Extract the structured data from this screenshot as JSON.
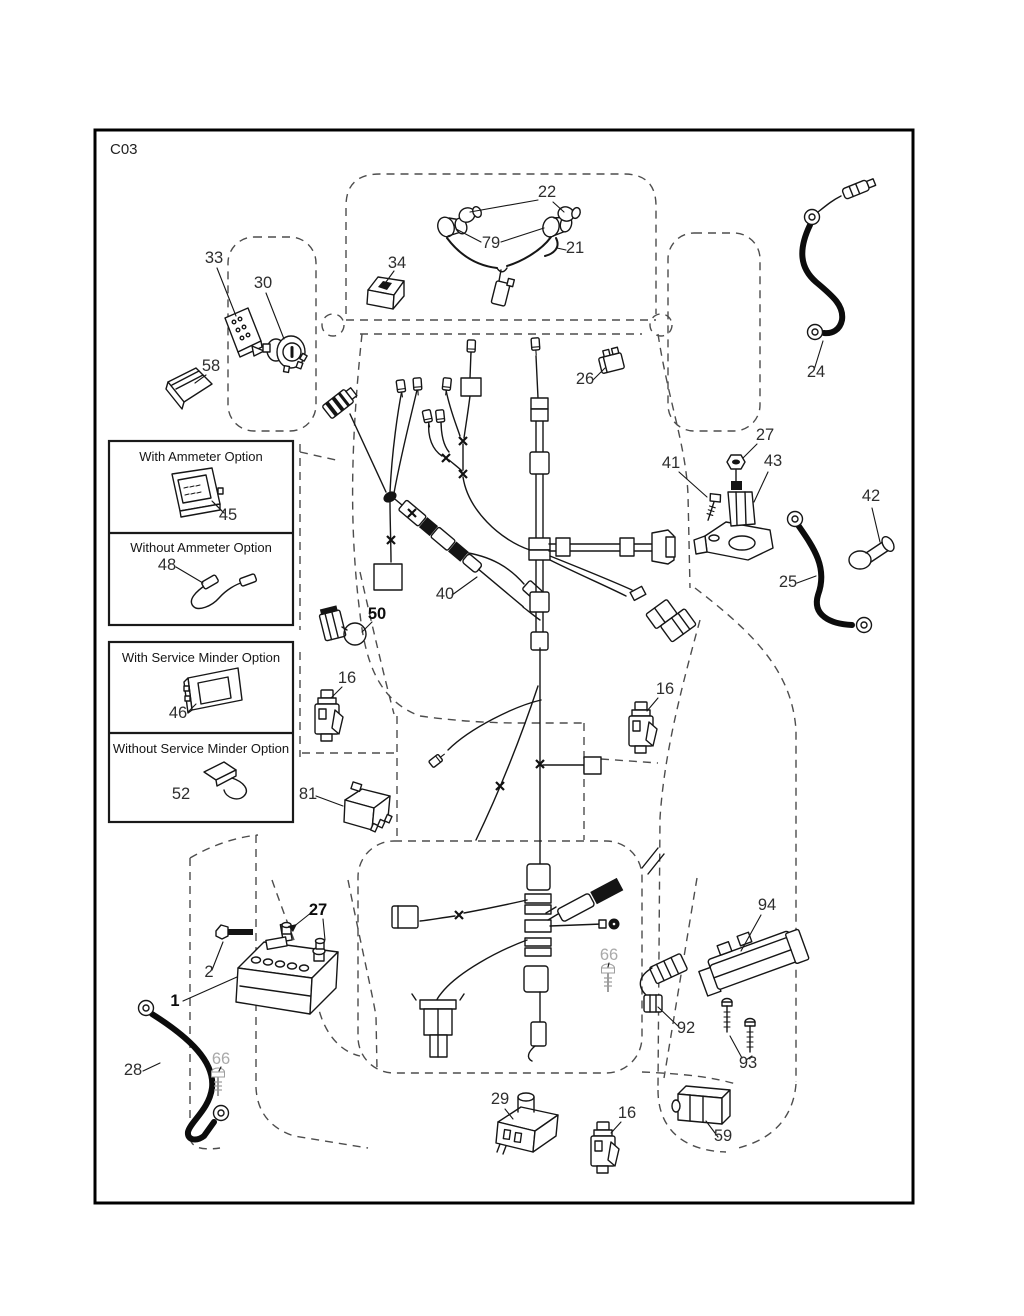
{
  "page": {
    "code": "C03"
  },
  "option_boxes": {
    "ammeter": {
      "with_label": "With Ammeter Option",
      "without_label": "Without Ammeter Option",
      "with_item": "45",
      "without_item": "48"
    },
    "service_minder": {
      "with_label": "With Service Minder Option",
      "without_label": "Without Service Minder Option",
      "with_item": "46",
      "without_item": "52"
    }
  },
  "colors": {
    "line": "#161616",
    "dashed_outline": "#4d4d4d",
    "muted_label": "#a9a9a9",
    "background": "#ffffff"
  },
  "diagram": {
    "callouts": [
      {
        "label": "22",
        "x": 547,
        "y": 197
      },
      {
        "label": "79",
        "x": 491,
        "y": 248
      },
      {
        "label": "21",
        "x": 575,
        "y": 253
      },
      {
        "label": "34",
        "x": 397,
        "y": 268
      },
      {
        "label": "33",
        "x": 214,
        "y": 263
      },
      {
        "label": "30",
        "x": 263,
        "y": 288
      },
      {
        "label": "58",
        "x": 211,
        "y": 371
      },
      {
        "label": "24",
        "x": 816,
        "y": 377
      },
      {
        "label": "26",
        "x": 585,
        "y": 384
      },
      {
        "label": "27",
        "x": 765,
        "y": 440
      },
      {
        "label": "41",
        "x": 671,
        "y": 468
      },
      {
        "label": "43",
        "x": 773,
        "y": 466
      },
      {
        "label": "42",
        "x": 871,
        "y": 501
      },
      {
        "label": "25",
        "x": 788,
        "y": 587
      },
      {
        "label": "45",
        "x": 228,
        "y": 520
      },
      {
        "label": "48",
        "x": 167,
        "y": 570
      },
      {
        "label": "46",
        "x": 178,
        "y": 718
      },
      {
        "label": "52",
        "x": 181,
        "y": 799
      },
      {
        "label": "50",
        "x": 377,
        "y": 619,
        "bold": true
      },
      {
        "label": "40",
        "x": 445,
        "y": 599
      },
      {
        "label": "16",
        "x": 347,
        "y": 683
      },
      {
        "label": "16",
        "x": 665,
        "y": 694
      },
      {
        "label": "81",
        "x": 308,
        "y": 799
      },
      {
        "label": "27",
        "x": 318,
        "y": 915,
        "bold": true
      },
      {
        "label": "2",
        "x": 209,
        "y": 977
      },
      {
        "label": "1",
        "x": 175,
        "y": 1006,
        "bold": true
      },
      {
        "label": "28",
        "x": 133,
        "y": 1075
      },
      {
        "label": "66",
        "x": 221,
        "y": 1064,
        "muted": true
      },
      {
        "label": "66",
        "x": 609,
        "y": 960,
        "muted": true
      },
      {
        "label": "29",
        "x": 500,
        "y": 1104
      },
      {
        "label": "16",
        "x": 627,
        "y": 1118
      },
      {
        "label": "59",
        "x": 723,
        "y": 1141
      },
      {
        "label": "94",
        "x": 767,
        "y": 910
      },
      {
        "label": "92",
        "x": 686,
        "y": 1033
      },
      {
        "label": "93",
        "x": 748,
        "y": 1068
      }
    ]
  }
}
